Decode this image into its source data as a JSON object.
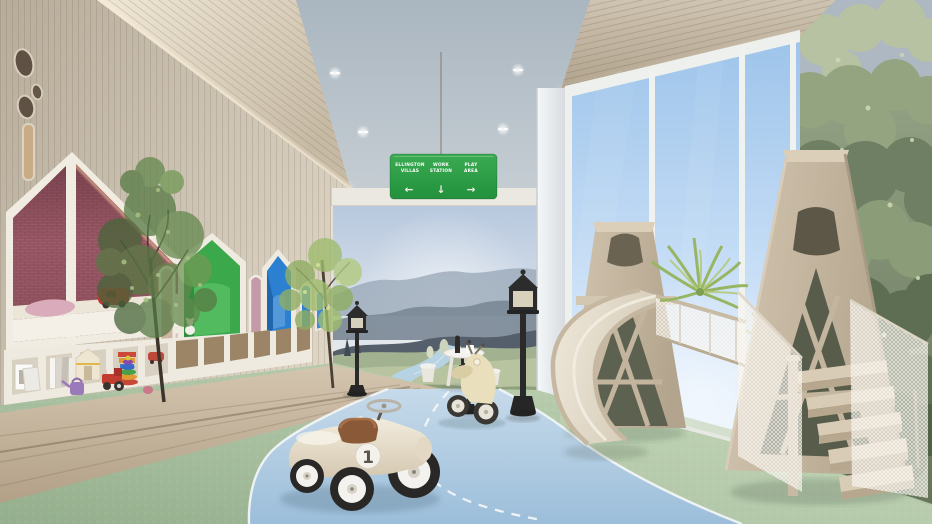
{
  "signage": {
    "hanging_sign": {
      "background": "#2d9d46",
      "text_color": "#ffffff",
      "items": [
        {
          "line1": "ELLINGTON",
          "line2": "VILLAS",
          "arrow": "←",
          "arrow_name": "arrow-left-icon"
        },
        {
          "line1": "WORK",
          "line2": "STATION",
          "arrow": "↓",
          "arrow_name": "arrow-down-icon"
        },
        {
          "line1": "PLAY",
          "line2": "AREA",
          "arrow": "→",
          "arrow_name": "arrow-right-icon"
        }
      ]
    }
  },
  "toys": {
    "race_car_number": "1"
  },
  "palette": {
    "sign_green": "#2d9d46",
    "pink_house": "#a5606e",
    "green_house": "#3aa84b",
    "blue_house": "#2b80d1",
    "road_blue": "#a9c6de",
    "carpet_green": "#a9c3a0",
    "wood_wall": "#cfc5b4",
    "play_wood": "#c9bba6",
    "mural_sky": "#c0cfe2",
    "window_sky": "#a6c9ec",
    "forest_mural": "#8fa07e"
  }
}
